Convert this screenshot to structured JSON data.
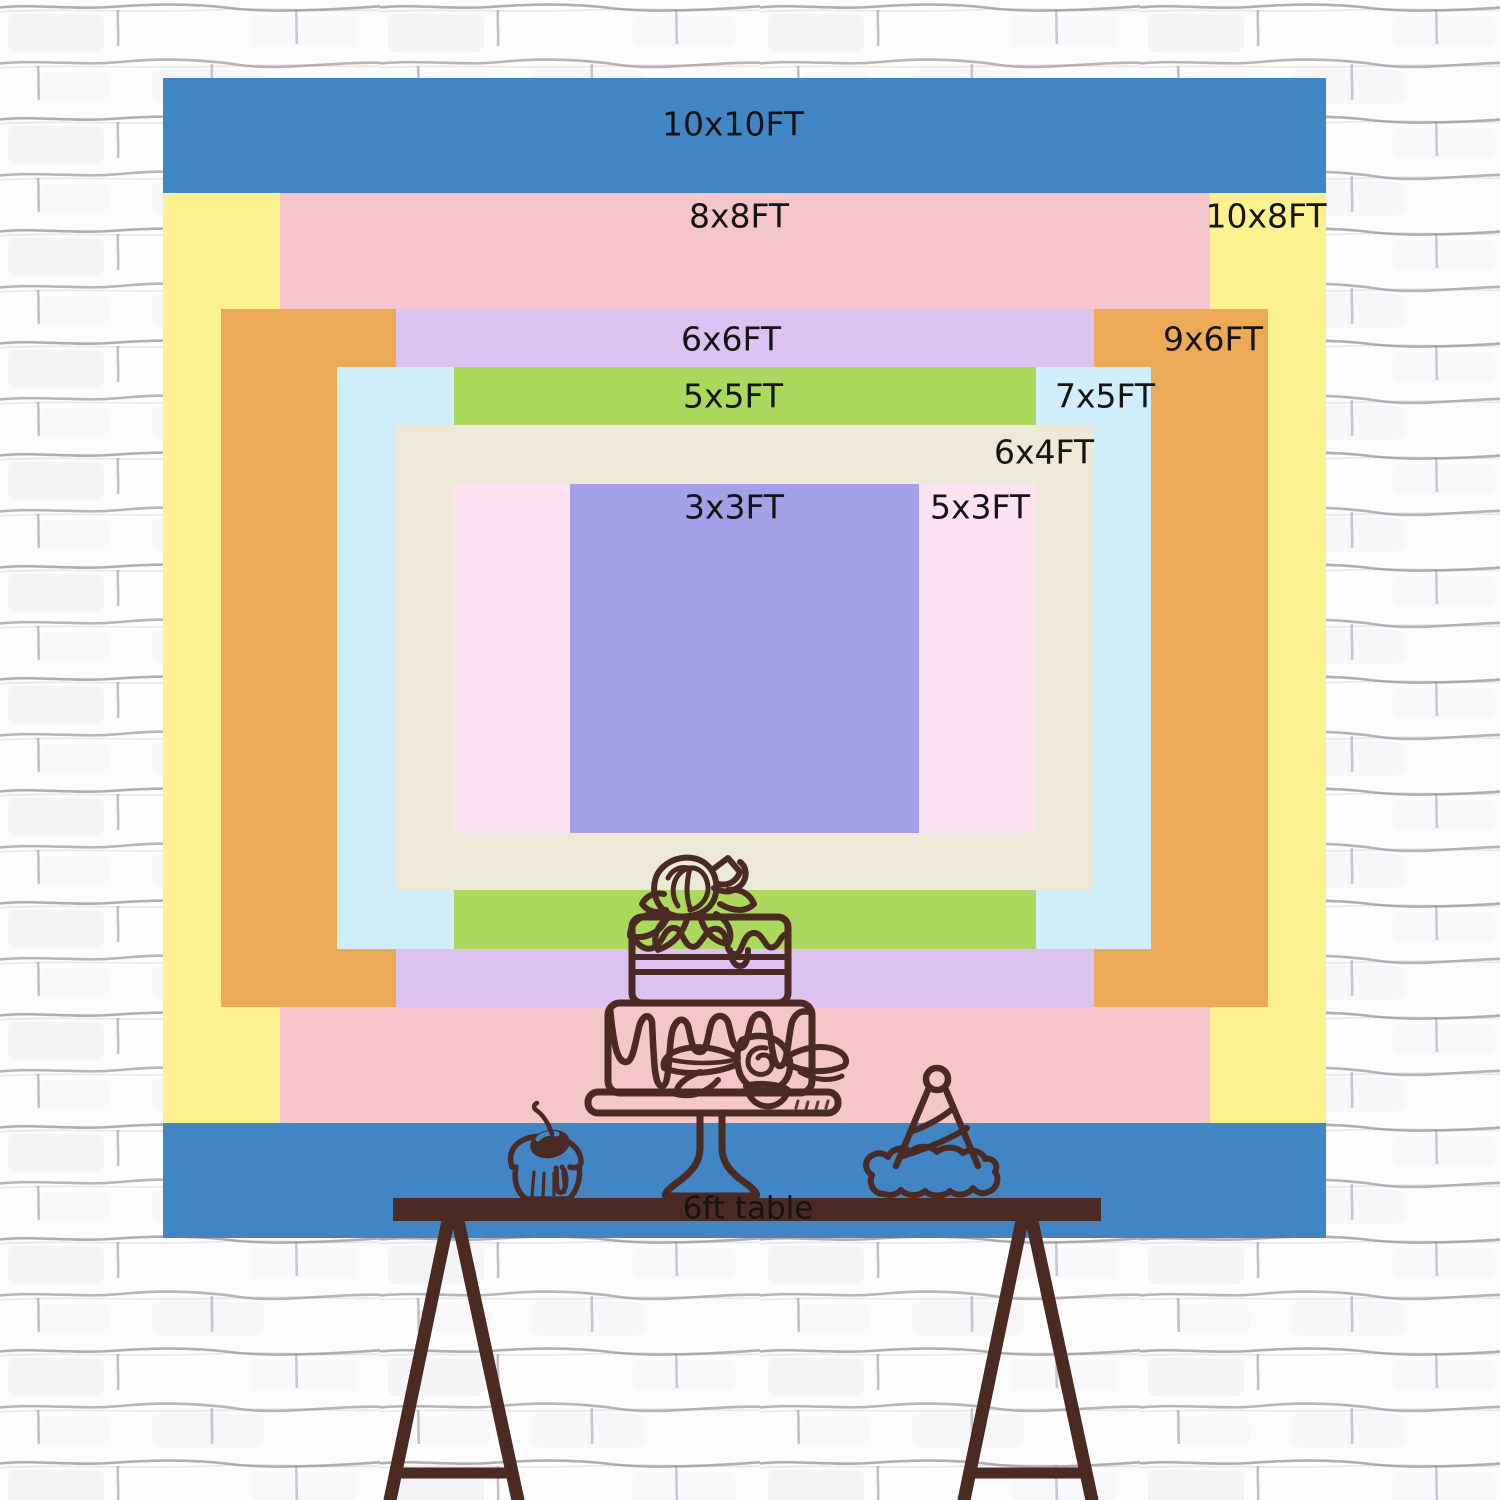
{
  "backdrop": {
    "sizes": [
      {
        "label": "10x10FT",
        "width_ft": 10,
        "height_ft": 10,
        "color": "#4285c4"
      },
      {
        "label": "10x8FT",
        "width_ft": 10,
        "height_ft": 8,
        "color": "#fbf18e"
      },
      {
        "label": "8x8FT",
        "width_ft": 8,
        "height_ft": 8,
        "color": "#f4c6c9"
      },
      {
        "label": "9x6FT",
        "width_ft": 9,
        "height_ft": 6,
        "color": "#ecaa56"
      },
      {
        "label": "6x6FT",
        "width_ft": 6,
        "height_ft": 6,
        "color": "#dcc2f1"
      },
      {
        "label": "7x5FT",
        "width_ft": 7,
        "height_ft": 5,
        "color": "#cfeef9"
      },
      {
        "label": "5x5FT",
        "width_ft": 5,
        "height_ft": 5,
        "color": "#abd95e"
      },
      {
        "label": "6x4FT",
        "width_ft": 6,
        "height_ft": 4,
        "color": "#ece9d8"
      },
      {
        "label": "5x3FT",
        "width_ft": 5,
        "height_ft": 3,
        "color": "#fde3f0"
      },
      {
        "label": "3x3FT",
        "width_ft": 3,
        "height_ft": 3,
        "color": "#a3a0e8"
      }
    ]
  },
  "table": {
    "label": "6ft table",
    "color": "#4b2a23"
  },
  "decorations": [
    {
      "name": "tiered-cake-on-stand"
    },
    {
      "name": "cupcake-with-cherry"
    },
    {
      "name": "party-hat"
    }
  ],
  "colors": {
    "label_text": "#141414",
    "line_art": "#4b2a23",
    "wall_background": "#fcfcfd",
    "wall_mortar_line": "#85858d"
  }
}
